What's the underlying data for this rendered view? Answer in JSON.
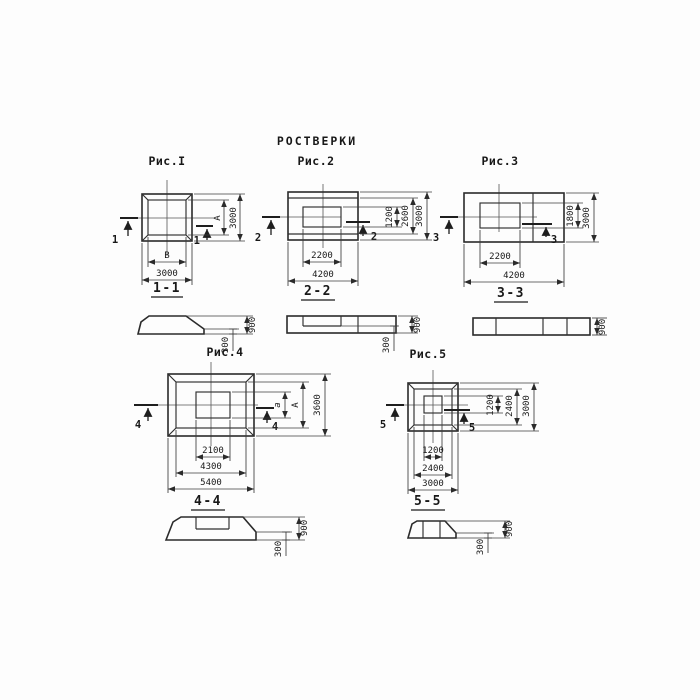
{
  "title": "РОСТВЕРКИ",
  "colors": {
    "background": "#fdfdfd",
    "line": "#2b2b2b",
    "text": "#181818"
  },
  "figures": [
    {
      "label": "Рис.I",
      "cut_number": "1",
      "section_title": "1-1",
      "plan_dims": {
        "inner_width": "В",
        "outer_width": "3000",
        "inner_height": "А",
        "outer_height": "3000"
      },
      "section_dims": {
        "total_height": "900",
        "ledge_height": "300"
      }
    },
    {
      "label": "Рис.2",
      "cut_number": "2",
      "section_title": "2-2",
      "plan_dims": {
        "inner_width": "2200",
        "outer_width": "4200",
        "socket_height": "1200",
        "mid_height": "2600",
        "outer_height": "3000"
      },
      "section_dims": {
        "total_height": "900",
        "ledge_height": "300"
      }
    },
    {
      "label": "Рис.3",
      "cut_number": "3",
      "section_title": "3-3",
      "plan_dims": {
        "inner_width": "2200",
        "outer_width": "4200",
        "inner_height": "1800",
        "outer_height": "3000"
      },
      "section_dims": {
        "total_height": "900"
      }
    },
    {
      "label": "Рис.4",
      "cut_number": "4",
      "section_title": "4-4",
      "plan_dims": {
        "socket_width": "2100",
        "mid_width": "4300",
        "outer_width": "5400",
        "socket_height": "а",
        "mid_height": "А",
        "outer_height": "3600"
      },
      "section_dims": {
        "total_height": "900",
        "ledge_height": "300"
      }
    },
    {
      "label": "Рис.5",
      "cut_number": "5",
      "section_title": "5-5",
      "plan_dims": {
        "socket_width": "1200",
        "mid_width": "2400",
        "outer_width": "3000",
        "socket_height": "1200",
        "mid_height": "2400",
        "outer_height": "3000"
      },
      "section_dims": {
        "total_height": "900",
        "ledge_height": "300"
      }
    }
  ]
}
